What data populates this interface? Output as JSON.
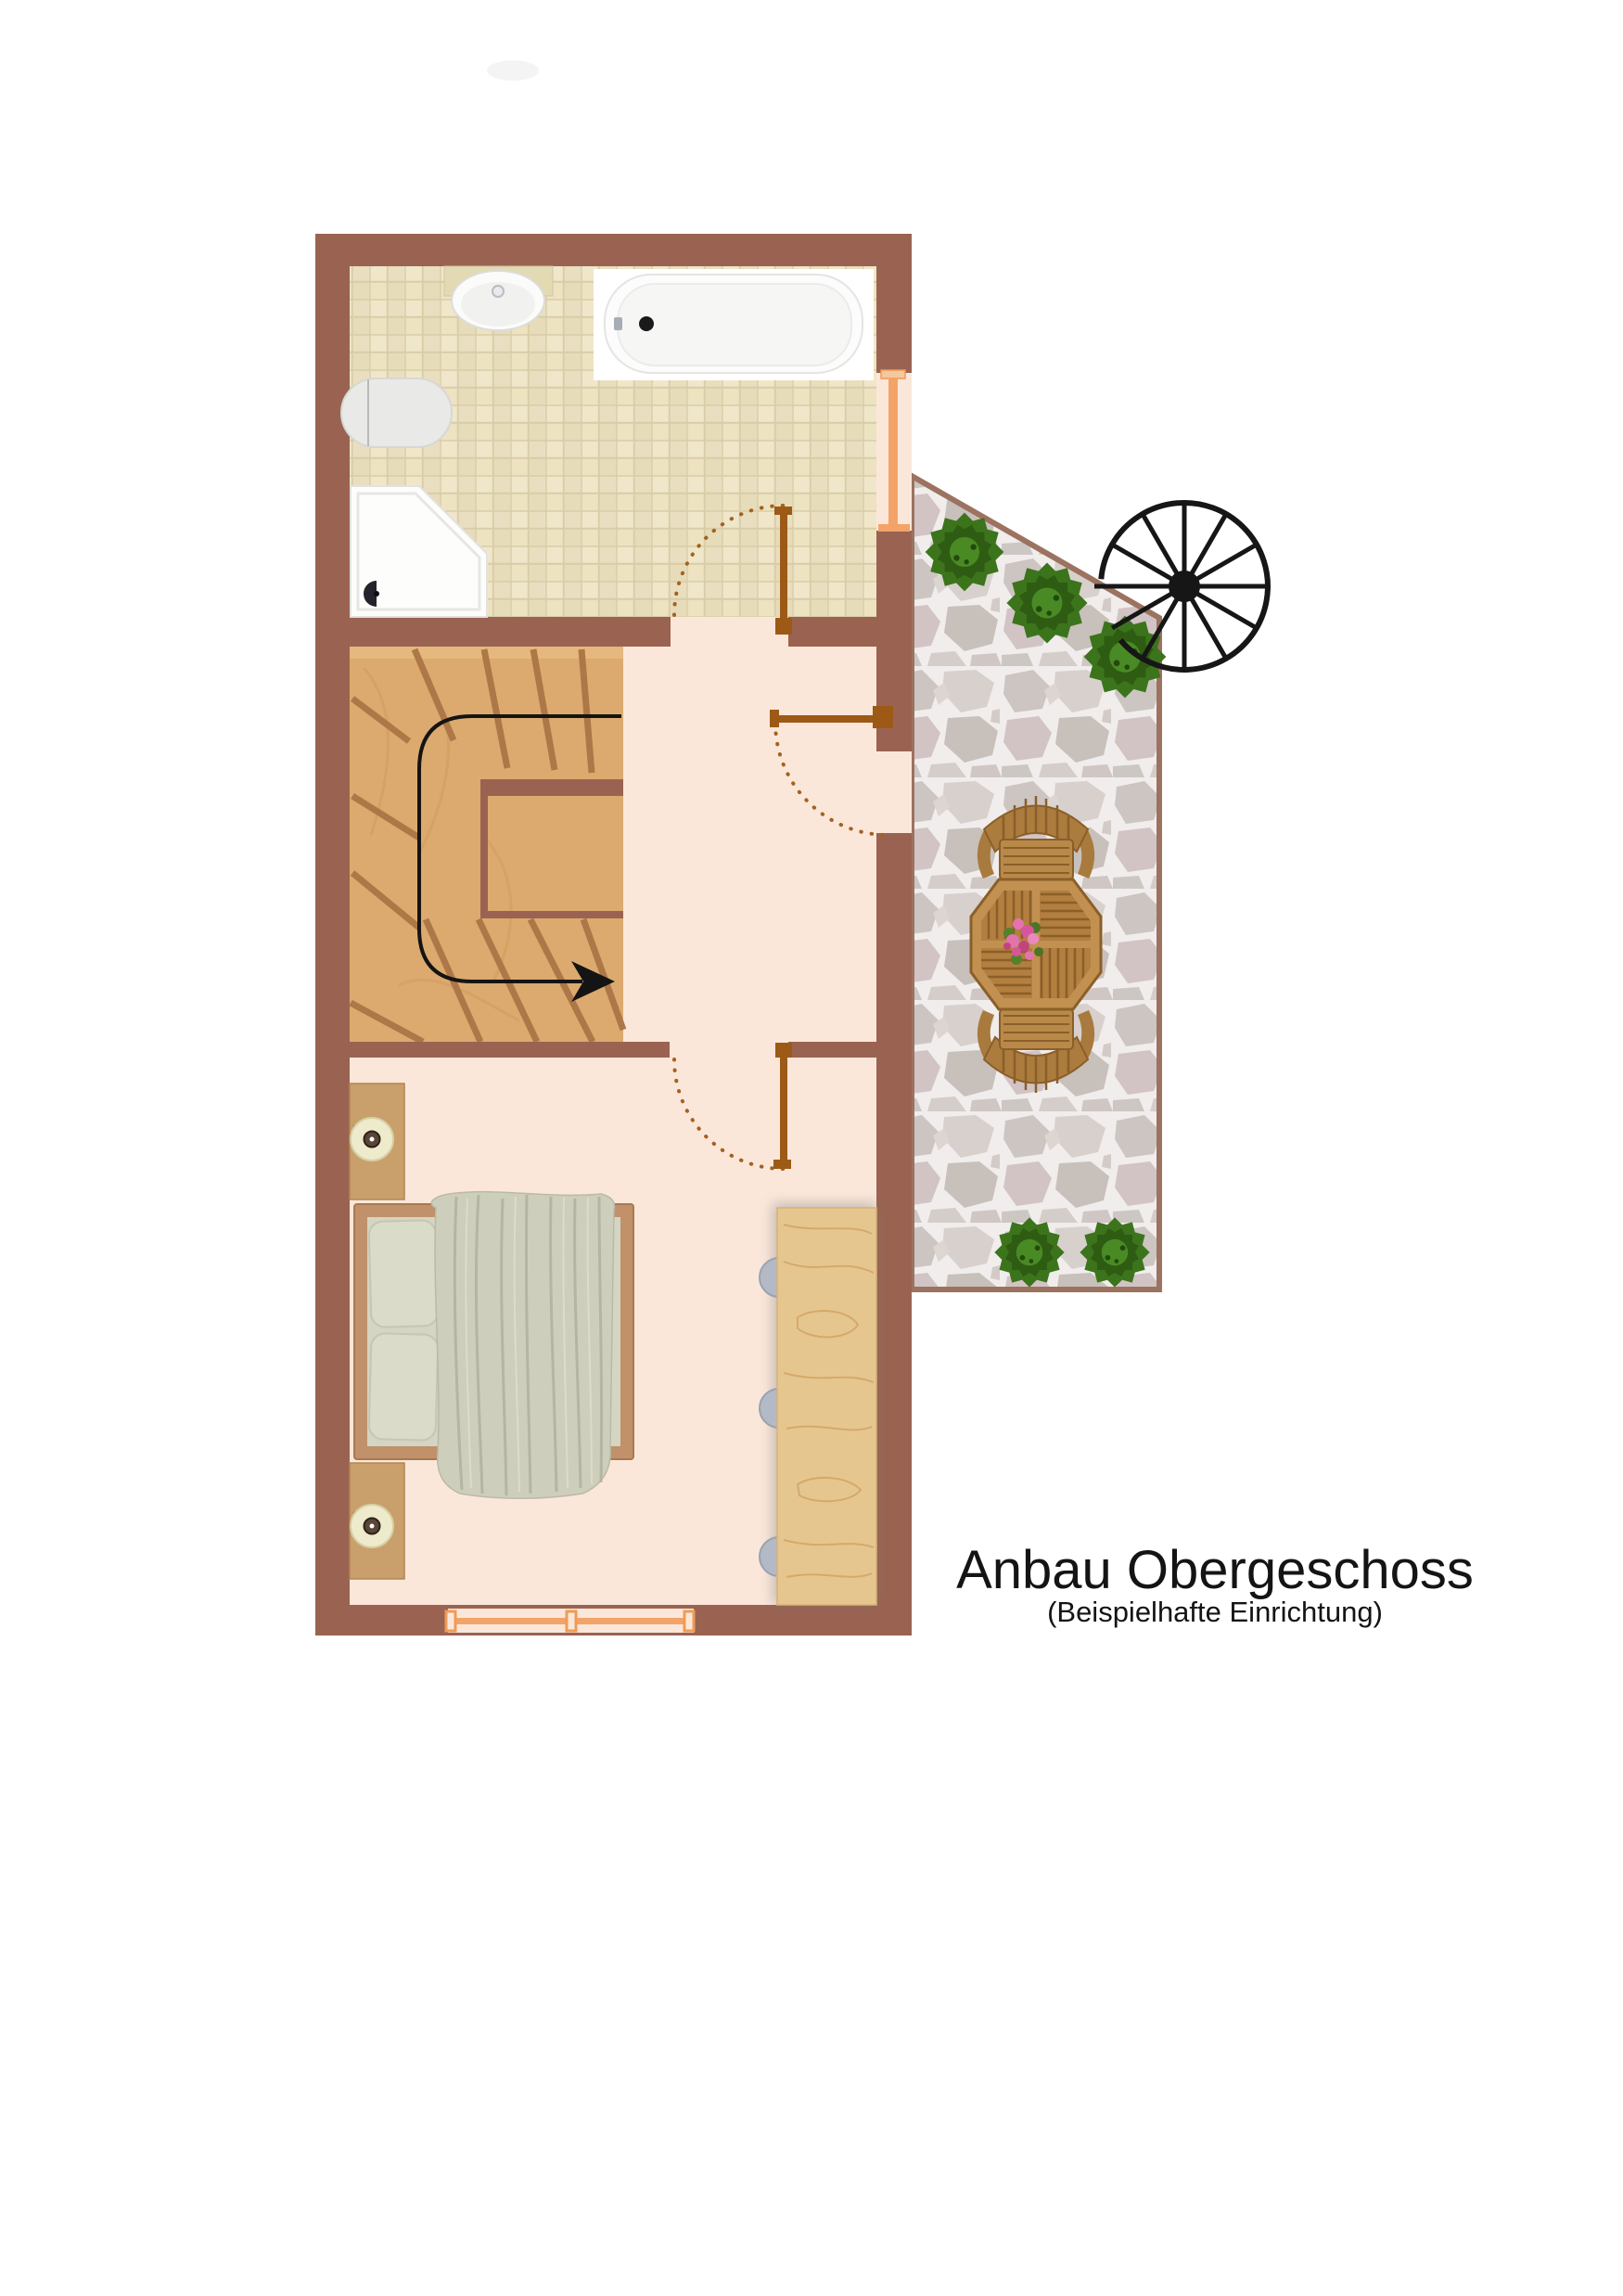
{
  "title": {
    "main": "Anbau Obergeschoss",
    "subtitle": "(Beispielhafte Einrichtung)"
  },
  "palette": {
    "wall_brown": "#9a6351",
    "tile_floor": "#ece2c3",
    "room_floor": "#fbe7da",
    "stair_wood": "#dcaa6e",
    "stair_tread": "#ad7748",
    "door_wood": "#9c5a16",
    "door_arc": "#a4621f",
    "window_accent": "#f4a368",
    "terrace_border": "#9c7260",
    "stone_grout": "#f0edec",
    "bush_green": "#3c741c",
    "patio_wood": "#c29050",
    "bedding_sage": "#cdcebb",
    "walkline_black": "#141414",
    "text_black": "#141414"
  },
  "symbols": {
    "spiral_staircase": "spiral-staircase-icon",
    "walk_direction": "walk-direction-arrow",
    "door_swing": "door-swing-arc",
    "bush": "bush-icon",
    "patio_set": "patio-table-and-chairs"
  }
}
